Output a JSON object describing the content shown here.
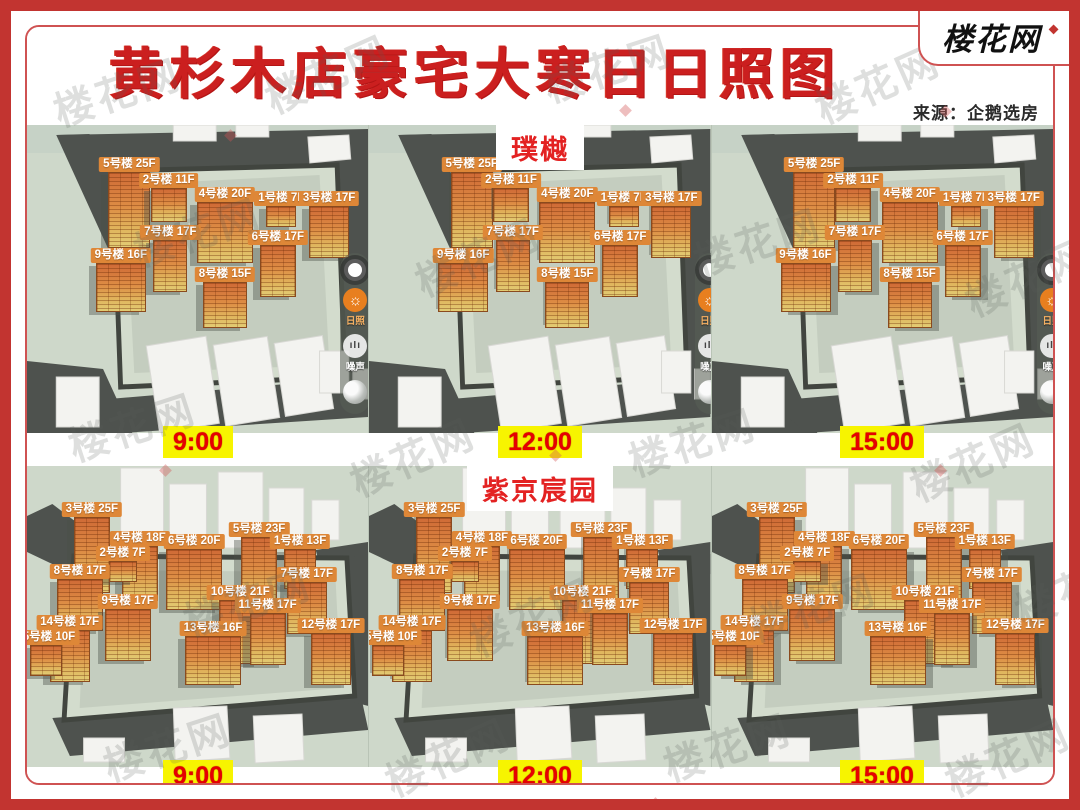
{
  "title": "黄杉木店豪宅大寒日日照图",
  "logo": {
    "text": "楼花网"
  },
  "source": "来源：企鹅选房",
  "watermark": "楼花网",
  "times": [
    "9:00",
    "12:00",
    "15:00"
  ],
  "toolbar": {
    "sun_label": "日照",
    "noise_label": "噪声"
  },
  "projects": {
    "puyue": {
      "name": "璞樾",
      "buildings": [
        {
          "label": "5号楼 25F",
          "f": 25,
          "x": 30,
          "y": 10.5,
          "w": 42
        },
        {
          "label": "2号楼 11F",
          "f": 11,
          "x": 41.5,
          "y": 15.5,
          "w": 36
        },
        {
          "label": "4号楼 20F",
          "f": 20,
          "x": 58,
          "y": 20,
          "w": 56
        },
        {
          "label": "1号楼 7F",
          "f": 7,
          "x": 74.5,
          "y": 21.5,
          "w": 30
        },
        {
          "label": "3号楼 17F",
          "f": 17,
          "x": 88.5,
          "y": 21.5,
          "w": 40
        },
        {
          "label": "7号楼 17F",
          "f": 17,
          "x": 42,
          "y": 32.5,
          "w": 34
        },
        {
          "label": "6号楼 17F",
          "f": 17,
          "x": 73.5,
          "y": 34,
          "w": 36
        },
        {
          "label": "9号楼 16F",
          "f": 16,
          "x": 27.5,
          "y": 40,
          "w": 50
        },
        {
          "label": "8号楼 15F",
          "f": 15,
          "x": 58,
          "y": 46,
          "w": 44
        }
      ]
    },
    "zijing": {
      "name": "紫京宸园",
      "buildings": [
        {
          "label": "3号楼 25F",
          "f": 25,
          "x": 19,
          "y": 12,
          "w": 36
        },
        {
          "label": "5号楼 23F",
          "f": 23,
          "x": 68,
          "y": 18.5,
          "w": 36
        },
        {
          "label": "4号楼 18F",
          "f": 18,
          "x": 33,
          "y": 21.5,
          "w": 36
        },
        {
          "label": "6号楼 20F",
          "f": 20,
          "x": 49,
          "y": 22.5,
          "w": 56
        },
        {
          "label": "1号楼 13F",
          "f": 13,
          "x": 80,
          "y": 22.5,
          "w": 32
        },
        {
          "label": "2号楼 7F",
          "f": 7,
          "x": 28,
          "y": 26.5,
          "w": 28
        },
        {
          "label": "8号楼 17F",
          "f": 17,
          "x": 15.5,
          "y": 32.5,
          "w": 46
        },
        {
          "label": "7号楼 17F",
          "f": 17,
          "x": 82,
          "y": 33.5,
          "w": 40
        },
        {
          "label": "10号楼 21F",
          "f": 21,
          "x": 62.5,
          "y": 39.5,
          "w": 42
        },
        {
          "label": "9号楼 17F",
          "f": 17,
          "x": 29.5,
          "y": 42.5,
          "w": 46
        },
        {
          "label": "11号楼 17F",
          "f": 17,
          "x": 70.5,
          "y": 44,
          "w": 36
        },
        {
          "label": "14号楼 17F",
          "f": 17,
          "x": 12.5,
          "y": 49.5,
          "w": 40
        },
        {
          "label": "12号楼 17F",
          "f": 17,
          "x": 89,
          "y": 50.5,
          "w": 40
        },
        {
          "label": "13号楼 16F",
          "f": 16,
          "x": 54.5,
          "y": 51.5,
          "w": 56
        },
        {
          "label": "15号楼 10F",
          "f": 10,
          "x": 5.5,
          "y": 54.5,
          "w": 32
        }
      ]
    }
  },
  "colors": {
    "accent_red": "#cb1f1f",
    "time_red": "#e60000",
    "chip_yellow": "#f7f400",
    "tag_orange": "#de8737",
    "map_green": "#ced8ca",
    "road_gray": "#4e524e",
    "border_red": "#c23430"
  }
}
